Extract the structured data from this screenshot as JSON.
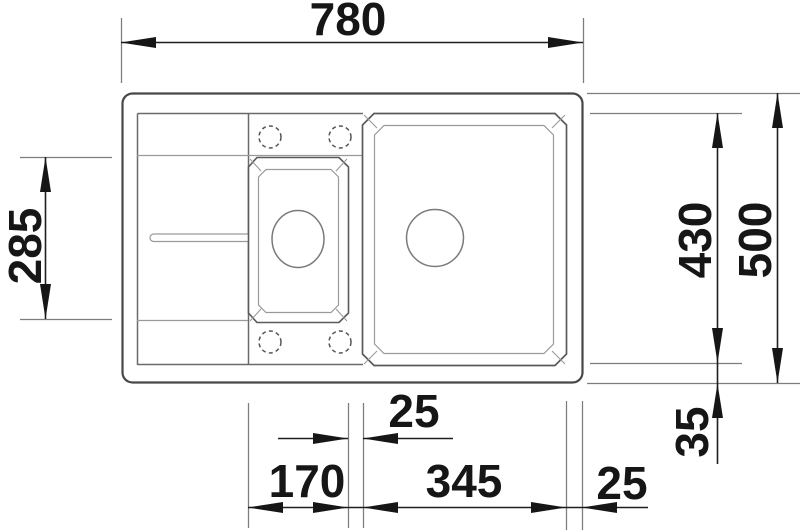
{
  "drawing": {
    "kind": "sink-top-view-technical-drawing",
    "dimensions": {
      "overall_width": "780",
      "overall_depth": "500",
      "inner_depth": "430",
      "drainer_bowl_length": "285",
      "bottom_rim": "35",
      "bowl_gap": "25",
      "small_bowl_width": "170",
      "main_bowl_width": "345",
      "right_rim": "25"
    }
  }
}
